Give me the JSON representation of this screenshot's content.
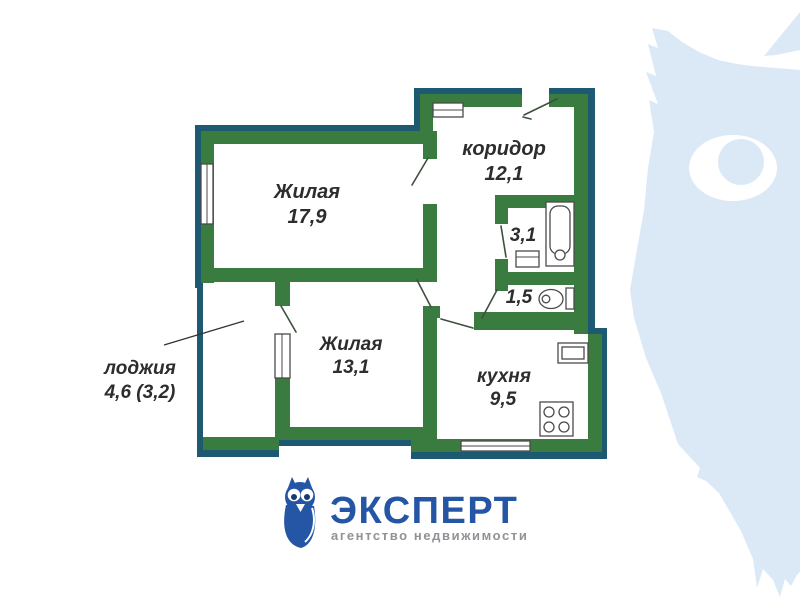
{
  "colors": {
    "wall_green": "#3a7b40",
    "outline_teal": "#1d5a72",
    "label_dark": "#2d2d2d",
    "logo_blue": "#2456a5",
    "logo_pupil_navy": "#163a73",
    "tagline_gray": "#8f9296",
    "watermark_blue": "#dbe9f7",
    "fixture_stroke": "#4a4a4a"
  },
  "plan": {
    "rooms": [
      {
        "id": "living1",
        "name": "Жилая",
        "area": "17,9"
      },
      {
        "id": "corridor",
        "name": "коридор",
        "area": "12,1"
      },
      {
        "id": "bath",
        "name": "",
        "area": "3,1"
      },
      {
        "id": "wc",
        "name": "",
        "area": "1,5"
      },
      {
        "id": "living2",
        "name": "Жилая",
        "area": "13,1"
      },
      {
        "id": "kitchen",
        "name": "кухня",
        "area": "9,5"
      },
      {
        "id": "loggia",
        "name": "лоджия",
        "area": "4,6 (3,2)"
      }
    ],
    "fixtures": [
      "bathtub",
      "bath-sink",
      "toilet",
      "kitchen-sink",
      "stove",
      "windows",
      "door-swings",
      "entrance-door"
    ]
  },
  "logo": {
    "brand": "ЭКСПЕРТ",
    "tagline": "агентство недвижимости"
  }
}
